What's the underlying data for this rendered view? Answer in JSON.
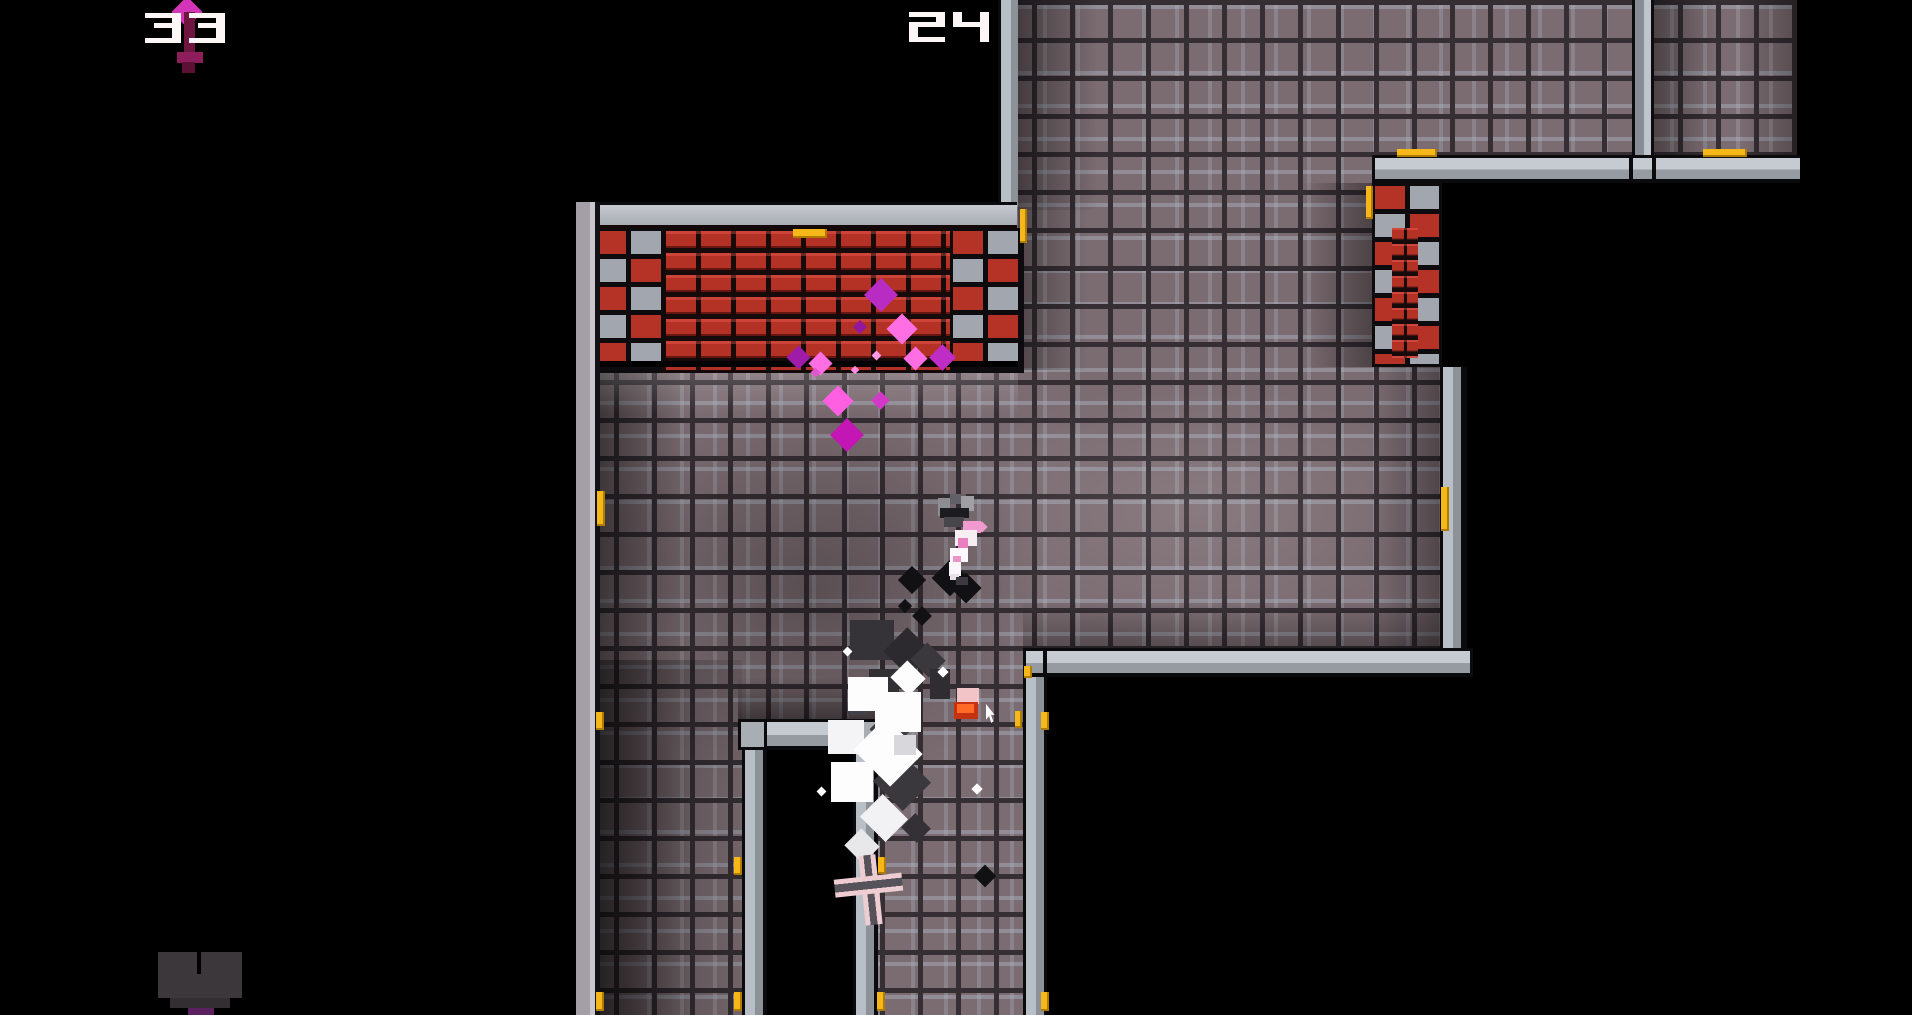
{
  "hud": {
    "left_counter": "33",
    "right_counter": "24",
    "left_icon": "dagger-icon",
    "text_color": "#fdf6f7"
  },
  "palette": {
    "tile_face": "#7b6c71",
    "tile_grout": "#352e33",
    "wall_light": "#c6cad1",
    "wall_mid": "#8d9198",
    "brick_red": "#b43126",
    "marker_yellow": "#f6b719",
    "smoke_white": "#fdfdfd",
    "smoke_dark": "#39373b",
    "blood_pink": "#ff6ee2",
    "blood_magenta": "#b82cc4",
    "heart_grey": "#3b373b",
    "heart_purple": "#5a2060"
  },
  "entities": {
    "player": {
      "name": "character",
      "x": 936,
      "y": 494
    },
    "dropped_item": {
      "name": "dropped-hat",
      "x": 953,
      "y": 687
    },
    "cross_item": {
      "name": "cross-weapon",
      "x": 835,
      "y": 853
    },
    "heart_pickup": {
      "name": "heart-pickup",
      "x": 158,
      "y": 950
    },
    "aim_cursor": {
      "name": "aim-cursor",
      "x": 986,
      "y": 704
    }
  },
  "particles": {
    "pink": [
      {
        "x": 881,
        "y": 295,
        "s": 24,
        "c": "#b82cc4"
      },
      {
        "x": 902,
        "y": 329,
        "s": 22,
        "c": "#ff6ee2"
      },
      {
        "x": 860,
        "y": 327,
        "s": 10,
        "c": "#93189c"
      },
      {
        "x": 798,
        "y": 357,
        "s": 17,
        "c": "#a01ca8"
      },
      {
        "x": 820,
        "y": 363,
        "s": 17,
        "c": "#ff6ee2"
      },
      {
        "x": 876,
        "y": 355,
        "s": 7,
        "c": "#ff9ae8"
      },
      {
        "x": 915,
        "y": 358,
        "s": 17,
        "c": "#ff6ee2"
      },
      {
        "x": 942,
        "y": 357,
        "s": 19,
        "c": "#c02cc6"
      },
      {
        "x": 855,
        "y": 370,
        "s": 6,
        "c": "#ff8ae8"
      },
      {
        "x": 838,
        "y": 401,
        "s": 22,
        "c": "#ff5fe0"
      },
      {
        "x": 847,
        "y": 435,
        "s": 24,
        "c": "#c316b4"
      },
      {
        "x": 880,
        "y": 400,
        "s": 13,
        "c": "#d339c8"
      },
      {
        "x": 815,
        "y": 372,
        "s": 7,
        "c": "#e355d0"
      }
    ],
    "dark": [
      {
        "x": 912,
        "y": 580,
        "s": 20
      },
      {
        "x": 950,
        "y": 578,
        "s": 26
      },
      {
        "x": 966,
        "y": 588,
        "s": 22
      },
      {
        "x": 985,
        "y": 876,
        "s": 16
      },
      {
        "x": 905,
        "y": 606,
        "s": 10
      },
      {
        "x": 922,
        "y": 616,
        "s": 14
      }
    ],
    "sparks": [
      {
        "x": 847,
        "y": 651,
        "s": 7
      },
      {
        "x": 943,
        "y": 672,
        "s": 8
      },
      {
        "x": 977,
        "y": 789,
        "s": 8
      },
      {
        "x": 821,
        "y": 791,
        "s": 7
      }
    ],
    "smoke_white": [
      {
        "x": 868,
        "y": 694,
        "w": 40,
        "h": 34,
        "c": "#fdfdfd",
        "r": 0
      },
      {
        "x": 898,
        "y": 712,
        "w": 46,
        "h": 40,
        "c": "#fdfdfd",
        "r": 0
      },
      {
        "x": 846,
        "y": 737,
        "w": 36,
        "h": 34,
        "c": "#f4f4f6",
        "r": 0
      },
      {
        "x": 888,
        "y": 752,
        "w": 52,
        "h": 46,
        "c": "#fdfdfd",
        "r": 45
      },
      {
        "x": 852,
        "y": 782,
        "w": 42,
        "h": 40,
        "c": "#fdfdfd",
        "r": 0
      },
      {
        "x": 884,
        "y": 818,
        "w": 36,
        "h": 32,
        "c": "#f2f2f4",
        "r": 45
      },
      {
        "x": 908,
        "y": 678,
        "w": 26,
        "h": 24,
        "c": "#fdfdfd",
        "r": 45
      },
      {
        "x": 862,
        "y": 846,
        "w": 26,
        "h": 24,
        "c": "#e8e8ea",
        "r": 45
      },
      {
        "x": 905,
        "y": 745,
        "w": 22,
        "h": 20,
        "c": "#d8d8dc",
        "r": 0
      }
    ],
    "smoke_dark": [
      {
        "x": 872,
        "y": 640,
        "w": 44,
        "h": 40,
        "c": "#353338",
        "r": 0
      },
      {
        "x": 908,
        "y": 652,
        "w": 36,
        "h": 34,
        "c": "#2c2a2e",
        "r": 45
      },
      {
        "x": 928,
        "y": 660,
        "w": 26,
        "h": 24,
        "c": "#3a383c",
        "r": 45
      },
      {
        "x": 884,
        "y": 682,
        "w": 30,
        "h": 26,
        "c": "#313034",
        "r": 0
      },
      {
        "x": 940,
        "y": 684,
        "w": 20,
        "h": 30,
        "c": "#2f2d31",
        "r": 0
      },
      {
        "x": 890,
        "y": 730,
        "w": 30,
        "h": 28,
        "c": "#3f3d41",
        "r": 45
      },
      {
        "x": 902,
        "y": 782,
        "w": 42,
        "h": 40,
        "c": "#3a383c",
        "r": 45
      },
      {
        "x": 916,
        "y": 828,
        "w": 22,
        "h": 20,
        "c": "#333135",
        "r": 45
      },
      {
        "x": 858,
        "y": 700,
        "w": 20,
        "h": 30,
        "c": "#434147",
        "r": 0
      }
    ]
  },
  "markers": [
    {
      "x": 793,
      "y": 229,
      "w": 34,
      "h": 9
    },
    {
      "x": 1397,
      "y": 149,
      "w": 40,
      "h": 8
    },
    {
      "x": 1703,
      "y": 149,
      "w": 44,
      "h": 8
    },
    {
      "x": 1366,
      "y": 186,
      "w": 7,
      "h": 33
    },
    {
      "x": 1020,
      "y": 209,
      "w": 7,
      "h": 34
    },
    {
      "x": 1441,
      "y": 487,
      "w": 8,
      "h": 44
    },
    {
      "x": 597,
      "y": 491,
      "w": 8,
      "h": 35
    },
    {
      "x": 596,
      "y": 712,
      "w": 8,
      "h": 18
    },
    {
      "x": 1015,
      "y": 711,
      "w": 7,
      "h": 17
    },
    {
      "x": 1041,
      "y": 712,
      "w": 8,
      "h": 18
    },
    {
      "x": 734,
      "y": 857,
      "w": 8,
      "h": 18
    },
    {
      "x": 878,
      "y": 857,
      "w": 8,
      "h": 17
    },
    {
      "x": 596,
      "y": 992,
      "w": 8,
      "h": 19
    },
    {
      "x": 734,
      "y": 992,
      "w": 8,
      "h": 19
    },
    {
      "x": 877,
      "y": 992,
      "w": 8,
      "h": 19
    },
    {
      "x": 1041,
      "y": 992,
      "w": 8,
      "h": 19
    },
    {
      "x": 1024,
      "y": 666,
      "w": 8,
      "h": 12
    }
  ]
}
